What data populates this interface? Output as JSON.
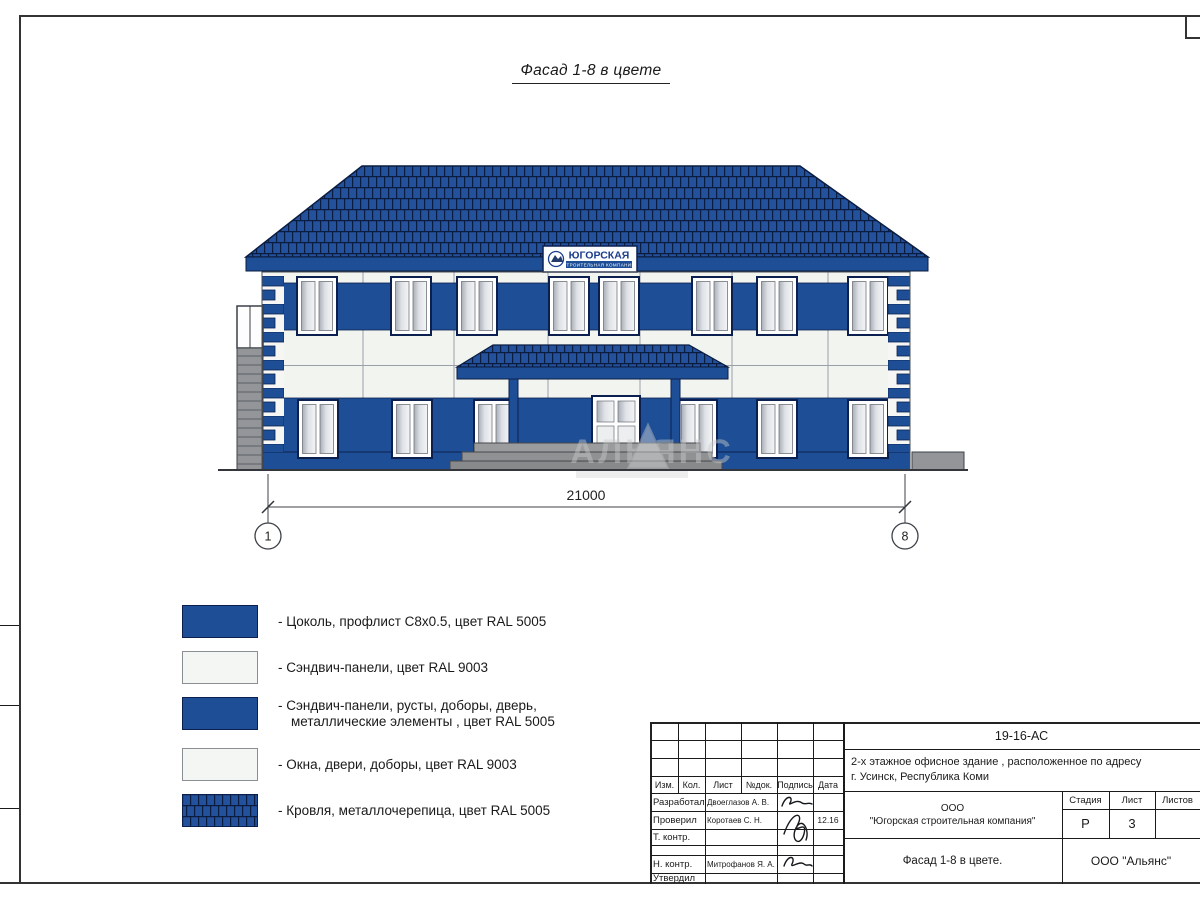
{
  "drawing": {
    "title": "Фасад 1-8 в цвете",
    "dimension": "21000",
    "axis_left": "1",
    "axis_right": "8",
    "sign_name": "ЮГОРСКАЯ",
    "sign_subtitle": "СТРОИТЕЛЬНАЯ КОМПАНИЯ",
    "watermark": "АЛЬЯНС"
  },
  "legend": {
    "items": [
      {
        "swatch": "blue",
        "label": "- Цоколь, профлист С8х0.5, цвет RAL 5005"
      },
      {
        "swatch": "white",
        "label": "- Сэндвич-панели, цвет RAL 9003"
      },
      {
        "swatch": "blue",
        "label": "- Сэндвич-панели, русты, доборы, дверь,\nметаллические элементы , цвет RAL 5005"
      },
      {
        "swatch": "white",
        "label": "- Окна, двери, доборы, цвет RAL 9003"
      },
      {
        "swatch": "roof",
        "label": "- Кровля, металлочерепица, цвет RAL 5005"
      }
    ]
  },
  "title_block": {
    "doc_number": "19-16-АС",
    "project_name": "2-х этажное офисное здание , расположенное по адресу\nг. Усинск, Республика Коми",
    "headers": {
      "izm": "Изм.",
      "kol": "Кол.",
      "list": "Лист",
      "ndok": "№док.",
      "podpis": "Подпись",
      "data": "Дата"
    },
    "rows": [
      {
        "role": "Разработал",
        "name": "Двоеглазов А. В.",
        "date": ""
      },
      {
        "role": "Проверил",
        "name": "Коротаев С. Н.",
        "date": "12.16"
      },
      {
        "role": "Т. контр.",
        "name": "",
        "date": ""
      },
      {
        "role": "Н. контр.",
        "name": "Митрофанов Я. А.",
        "date": ""
      },
      {
        "role": "Утвердил",
        "name": "",
        "date": ""
      }
    ],
    "company": "ООО\n\"Югорская строительная компания\"",
    "sheet_title": "Фасад 1-8 в цвете.",
    "stage_label": "Стадия",
    "sheet_label": "Лист",
    "sheets_label": "Листов",
    "stage_value": "Р",
    "sheet_value": "3",
    "sheets_value": "",
    "contractor": "ООО \"Альянс\""
  },
  "colors": {
    "ral5005_blue": "#1e4f96",
    "ral9003_white": "#f4f6f3",
    "roof_tile_blue": "#24519c",
    "outline_navy": "#0c2050"
  }
}
